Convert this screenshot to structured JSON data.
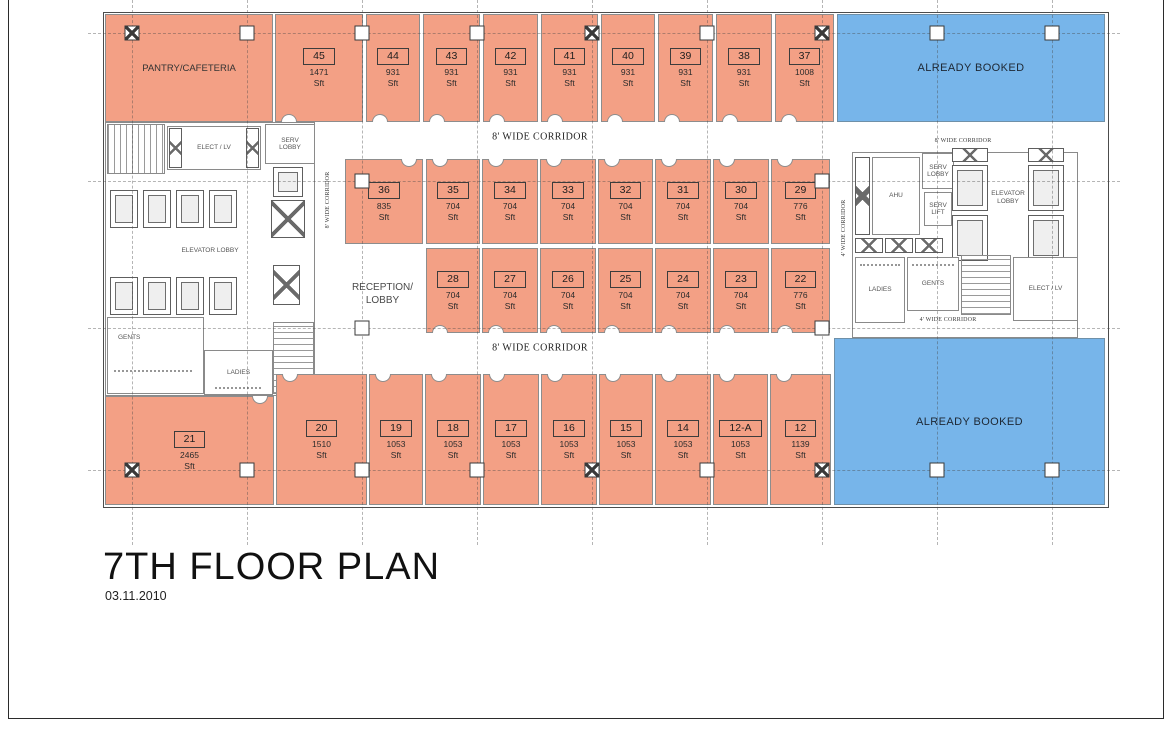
{
  "sheet": {
    "title": "7TH FLOOR PLAN",
    "date": "03.11.2010"
  },
  "palette": {
    "unit_fill": "#f3a085",
    "booked_fill": "#77b5ea",
    "wall": "#8d8d8d",
    "grid": "#707070",
    "text": "#1e1e1e"
  },
  "unit_area_suffix": "Sft",
  "special_areas": {
    "pantry": {
      "label": "PANTRY/CAFETERIA",
      "rect": [
        105,
        14,
        168,
        108
      ]
    },
    "booked": [
      {
        "label": "ALREADY BOOKED",
        "rect": [
          837,
          14,
          268,
          108
        ]
      },
      {
        "label": "ALREADY BOOKED",
        "rect": [
          834,
          338,
          271,
          167
        ]
      }
    ],
    "reception": {
      "label": "RECEPTION/\nLOBBY",
      "rect": [
        335,
        250,
        95,
        88
      ]
    }
  },
  "units": [
    {
      "no": "45",
      "area": "1471",
      "rect": [
        275,
        14,
        88,
        108
      ],
      "door": "b"
    },
    {
      "no": "44",
      "area": "931",
      "rect": [
        366,
        14,
        54,
        108
      ],
      "door": "b"
    },
    {
      "no": "43",
      "area": "931",
      "rect": [
        423,
        14,
        57,
        108
      ],
      "door": "b"
    },
    {
      "no": "42",
      "area": "931",
      "rect": [
        483,
        14,
        55,
        108
      ],
      "door": "b"
    },
    {
      "no": "41",
      "area": "931",
      "rect": [
        541,
        14,
        57,
        108
      ],
      "door": "b"
    },
    {
      "no": "40",
      "area": "931",
      "rect": [
        601,
        14,
        54,
        108
      ],
      "door": "b"
    },
    {
      "no": "39",
      "area": "931",
      "rect": [
        658,
        14,
        55,
        108
      ],
      "door": "b"
    },
    {
      "no": "38",
      "area": "931",
      "rect": [
        716,
        14,
        56,
        108
      ],
      "door": "b"
    },
    {
      "no": "37",
      "area": "1008",
      "rect": [
        775,
        14,
        59,
        108
      ],
      "door": "b"
    },
    {
      "no": "36",
      "area": "835",
      "rect": [
        345,
        159,
        78,
        85
      ],
      "door": "t",
      "align": "r"
    },
    {
      "no": "35",
      "area": "704",
      "rect": [
        426,
        159,
        54,
        85
      ],
      "door": "t"
    },
    {
      "no": "34",
      "area": "704",
      "rect": [
        482,
        159,
        56,
        85
      ],
      "door": "t"
    },
    {
      "no": "33",
      "area": "704",
      "rect": [
        540,
        159,
        56,
        85
      ],
      "door": "t"
    },
    {
      "no": "32",
      "area": "704",
      "rect": [
        598,
        159,
        55,
        85
      ],
      "door": "t"
    },
    {
      "no": "31",
      "area": "704",
      "rect": [
        655,
        159,
        56,
        85
      ],
      "door": "t"
    },
    {
      "no": "30",
      "area": "704",
      "rect": [
        713,
        159,
        56,
        85
      ],
      "door": "t"
    },
    {
      "no": "29",
      "area": "776",
      "rect": [
        771,
        159,
        59,
        85
      ],
      "door": "t"
    },
    {
      "no": "28",
      "area": "704",
      "rect": [
        426,
        248,
        54,
        85
      ],
      "door": "b"
    },
    {
      "no": "27",
      "area": "704",
      "rect": [
        482,
        248,
        56,
        85
      ],
      "door": "b"
    },
    {
      "no": "26",
      "area": "704",
      "rect": [
        540,
        248,
        56,
        85
      ],
      "door": "b"
    },
    {
      "no": "25",
      "area": "704",
      "rect": [
        598,
        248,
        55,
        85
      ],
      "door": "b"
    },
    {
      "no": "24",
      "area": "704",
      "rect": [
        655,
        248,
        56,
        85
      ],
      "door": "b"
    },
    {
      "no": "23",
      "area": "704",
      "rect": [
        713,
        248,
        56,
        85
      ],
      "door": "b"
    },
    {
      "no": "22",
      "area": "776",
      "rect": [
        771,
        248,
        59,
        85
      ],
      "door": "b"
    },
    {
      "no": "21",
      "area": "2465",
      "rect": [
        105,
        396,
        169,
        109
      ],
      "door": "t",
      "align": "r"
    },
    {
      "no": "20",
      "area": "1510",
      "rect": [
        276,
        374,
        91,
        131
      ],
      "door": "t"
    },
    {
      "no": "19",
      "area": "1053",
      "rect": [
        369,
        374,
        54,
        131
      ],
      "door": "t"
    },
    {
      "no": "18",
      "area": "1053",
      "rect": [
        425,
        374,
        56,
        131
      ],
      "door": "t"
    },
    {
      "no": "17",
      "area": "1053",
      "rect": [
        483,
        374,
        56,
        131
      ],
      "door": "t"
    },
    {
      "no": "16",
      "area": "1053",
      "rect": [
        541,
        374,
        56,
        131
      ],
      "door": "t"
    },
    {
      "no": "15",
      "area": "1053",
      "rect": [
        599,
        374,
        54,
        131
      ],
      "door": "t"
    },
    {
      "no": "14",
      "area": "1053",
      "rect": [
        655,
        374,
        56,
        131
      ],
      "door": "t"
    },
    {
      "no": "12-A",
      "area": "1053",
      "rect": [
        713,
        374,
        55,
        131
      ],
      "door": "t"
    },
    {
      "no": "12",
      "area": "1139",
      "rect": [
        770,
        374,
        61,
        131
      ],
      "door": "t"
    }
  ],
  "corridors": [
    {
      "id": "top",
      "label": "8' WIDE CORRIDOR",
      "x": 540,
      "y": 137
    },
    {
      "id": "bottom",
      "label": "8' WIDE CORRIDOR",
      "x": 540,
      "y": 348
    },
    {
      "id": "left-vertical",
      "label": "8' WIDE CORRIDOR",
      "x": 328,
      "y": 200,
      "rotate": true,
      "small": true
    },
    {
      "id": "right-vertical",
      "label": "4' WIDE CORRIDOR",
      "x": 844,
      "y": 228,
      "rotate": true,
      "small": true
    },
    {
      "id": "top-right",
      "label": "8' WIDE CORRIDOR",
      "x": 963,
      "y": 141,
      "small": true
    },
    {
      "id": "bottom-right",
      "label": "4' WIDE CORRIDOR",
      "x": 948,
      "y": 320,
      "small": true
    }
  ],
  "core_labels": {
    "elect_lv_left": "ELECT / LV",
    "serv_lobby_left": "SERV\nLOBBY",
    "elevator_lobby_left": "ELEVATOR LOBBY",
    "gents_left": "GENTS",
    "ladies_left": "LADIES",
    "ahu": "AHU",
    "serv_lobby_right": "SERV\nLOBBY",
    "serv_lift_right": "SERV\nLIFT",
    "elevator_lobby_right": "ELEVATOR\nLOBBY",
    "ladies_right": "LADIES",
    "gents_right": "GENTS",
    "elect_lv_right": "ELECT / LV"
  },
  "grid": {
    "vlines": [
      132,
      247,
      362,
      477,
      592,
      707,
      822,
      937,
      1052
    ],
    "hlines": [
      33,
      181,
      328,
      470
    ],
    "columns": [
      {
        "x": 132,
        "y": 33,
        "h": true
      },
      {
        "x": 247,
        "y": 33
      },
      {
        "x": 362,
        "y": 33
      },
      {
        "x": 477,
        "y": 33
      },
      {
        "x": 592,
        "y": 33,
        "h": true
      },
      {
        "x": 707,
        "y": 33
      },
      {
        "x": 822,
        "y": 33,
        "h": true
      },
      {
        "x": 937,
        "y": 33
      },
      {
        "x": 1052,
        "y": 33
      },
      {
        "x": 362,
        "y": 181
      },
      {
        "x": 822,
        "y": 181
      },
      {
        "x": 362,
        "y": 328
      },
      {
        "x": 822,
        "y": 328
      },
      {
        "x": 132,
        "y": 470,
        "h": true
      },
      {
        "x": 247,
        "y": 470
      },
      {
        "x": 362,
        "y": 470
      },
      {
        "x": 477,
        "y": 470
      },
      {
        "x": 592,
        "y": 470,
        "h": true
      },
      {
        "x": 707,
        "y": 470
      },
      {
        "x": 822,
        "y": 470,
        "h": true
      },
      {
        "x": 937,
        "y": 470
      },
      {
        "x": 1052,
        "y": 470
      }
    ]
  }
}
